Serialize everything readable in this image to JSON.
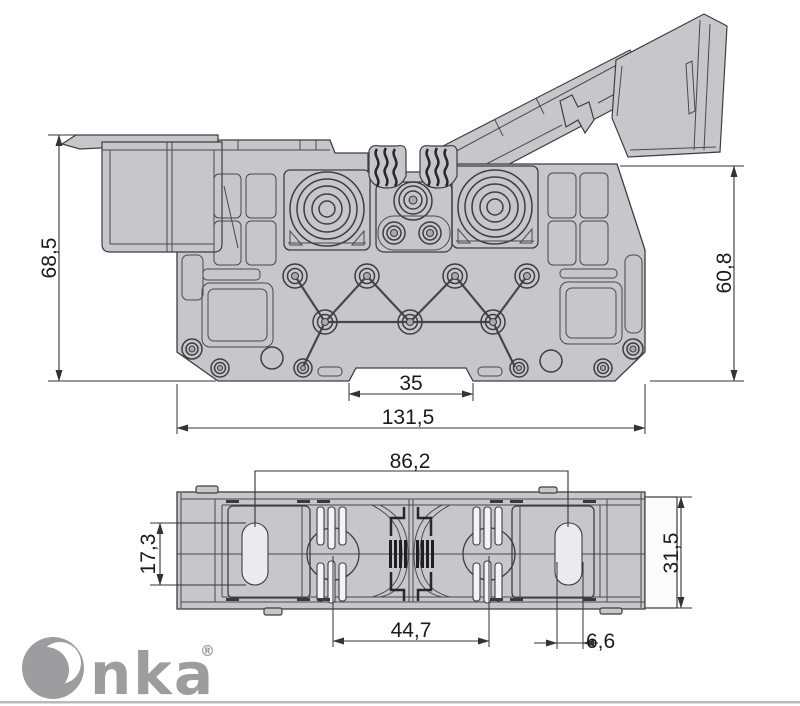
{
  "drawing": {
    "type": "technical-dimension-drawing",
    "part": "terminal block with hinged cover",
    "colors": {
      "body_fill": "#c7c7cb",
      "outline": "#3e3e42",
      "dimension_line": "#333333",
      "logo_gray": "#9d9d9f",
      "background": "#ffffff"
    },
    "dimensions": {
      "side_view": {
        "height_with_cover": "68,5",
        "body_height": "60,8",
        "din_notch_width": "35",
        "overall_width": "131,5"
      },
      "bottom_view": {
        "mounting_hole_spacing": "86,2",
        "slot_height": "17,3",
        "body_depth": "31,5",
        "contact_center_spacing": "44,7",
        "slot_width": "6,6"
      }
    }
  },
  "logo": {
    "mark": "O",
    "text": "nka",
    "registered": "®",
    "color": "#9d9d9f"
  }
}
